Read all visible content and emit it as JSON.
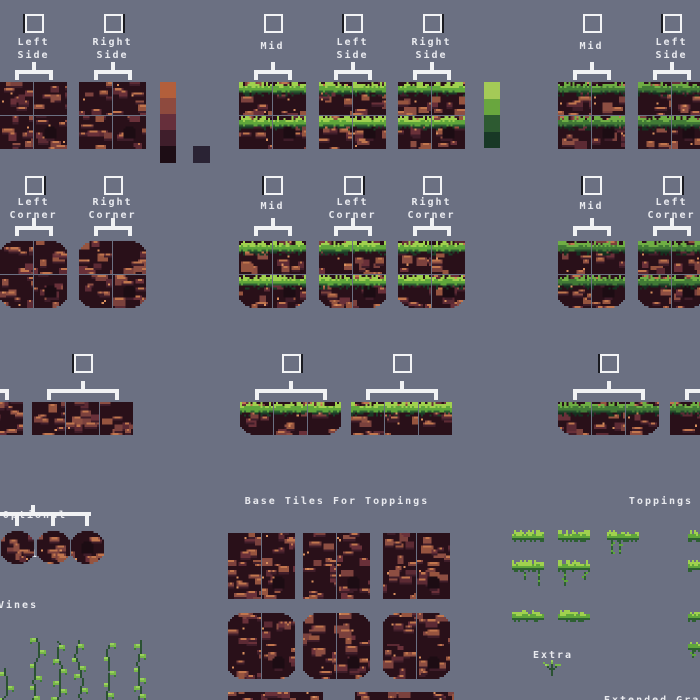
{
  "background": "#6b7082",
  "ui": {
    "checkbox_border": "#f2f3f5",
    "bracket_color": "#f1f2f4",
    "text_color": "#e9eaef"
  },
  "sections": {
    "optional_tiles": {
      "line1": "Optional",
      "line2": "Tiles"
    },
    "base_tiles": {
      "title": "Base Tiles For Toppings"
    },
    "toppings": {
      "title": "Toppings"
    },
    "vines": {
      "title": "Vines"
    },
    "extra": {
      "title": "Extra"
    },
    "extended_grass": {
      "title": "Extended Grass"
    }
  },
  "palettes": [
    {
      "name": "dirt-palette",
      "x": 160,
      "y": 82,
      "w": 16,
      "heights": [
        16,
        16,
        16,
        16,
        17
      ],
      "colors": [
        "#b35f3b",
        "#8e4a3e",
        "#662f3b",
        "#3f1e2b",
        "#1d0d15"
      ]
    },
    {
      "name": "dirt-extra-swatch",
      "x": 193,
      "y": 146,
      "w": 17,
      "heights": [
        17
      ],
      "colors": [
        "#2a2334"
      ]
    },
    {
      "name": "grass-palette",
      "x": 484,
      "y": 82,
      "w": 16,
      "heights": [
        17,
        16,
        17,
        16
      ],
      "colors": [
        "#a4ca57",
        "#69a63e",
        "#2d5a31",
        "#183826"
      ]
    }
  ],
  "row_presets": {
    "r1": {
      "cb": 14,
      "label": 36,
      "bracket": 62,
      "tiles": 82,
      "cols": 2,
      "rows": 2
    },
    "r2": {
      "cb": 176,
      "label": 196,
      "bracket": 218,
      "tiles": 241,
      "cols": 2,
      "rows": 2
    },
    "r3": {
      "cb": 354,
      "label": -1,
      "bracket": 381,
      "tiles": 402,
      "cols": 3,
      "rows": 1
    }
  },
  "tile_groups": [
    {
      "row": "r1",
      "label": [
        "Left",
        "Side"
      ],
      "variant": "dirt",
      "x": 0
    },
    {
      "row": "r1",
      "label": [
        "Right",
        "Side"
      ],
      "variant": "dirt",
      "x": 79
    },
    {
      "row": "r1",
      "label": [
        "Mid"
      ],
      "variant": "grass",
      "x": 239
    },
    {
      "row": "r1",
      "label": [
        "Left",
        "Side"
      ],
      "variant": "grass",
      "x": 319
    },
    {
      "row": "r1",
      "label": [
        "Right",
        "Side"
      ],
      "variant": "grass",
      "x": 398
    },
    {
      "row": "r1",
      "label": [
        "Mid"
      ],
      "variant": "darkgrass",
      "x": 558
    },
    {
      "row": "r1",
      "label": [
        "Left",
        "Side"
      ],
      "variant": "darkgrass",
      "x": 638
    },
    {
      "row": "r2",
      "label": [
        "Left",
        "Corner"
      ],
      "variant": "dirt",
      "x": 0,
      "round": "outer"
    },
    {
      "row": "r2",
      "label": [
        "Right",
        "Corner"
      ],
      "variant": "dirt",
      "x": 79,
      "round": "outer"
    },
    {
      "row": "r2",
      "label": [
        "Mid"
      ],
      "variant": "grass",
      "x": 239,
      "round": "bottom"
    },
    {
      "row": "r2",
      "label": [
        "Left",
        "Corner"
      ],
      "variant": "grass",
      "x": 319,
      "round": "bottom"
    },
    {
      "row": "r2",
      "label": [
        "Right",
        "Corner"
      ],
      "variant": "grass",
      "x": 398,
      "round": "bottom"
    },
    {
      "row": "r2",
      "label": [
        "Mid"
      ],
      "variant": "darkgrass",
      "x": 558,
      "round": "bottom"
    },
    {
      "row": "r2",
      "label": [
        "Left",
        "Corner"
      ],
      "variant": "darkgrass",
      "x": 638,
      "round": "bottom"
    },
    {
      "row": "r3",
      "label": [],
      "variant": "dirt",
      "x": -78
    },
    {
      "row": "r3",
      "label": [],
      "variant": "dirt",
      "x": 32
    },
    {
      "row": "r3",
      "label": [],
      "variant": "grass",
      "x": 240,
      "round": "bottom"
    },
    {
      "row": "r3",
      "label": [],
      "variant": "grass",
      "x": 351
    },
    {
      "row": "r3",
      "label": [],
      "variant": "darkgrass",
      "x": 558,
      "round": "bottom"
    },
    {
      "row": "r3",
      "label": [],
      "variant": "darkgrass",
      "x": 670
    }
  ],
  "optional_row": {
    "y": 531,
    "xs": [
      1,
      37,
      71
    ]
  },
  "base_blocks": [
    {
      "x": 228,
      "y": 533,
      "cols": 2,
      "rows": 2
    },
    {
      "x": 303,
      "y": 533,
      "cols": 2,
      "rows": 2
    },
    {
      "x": 383,
      "y": 533,
      "cols": 2,
      "rows": 2
    },
    {
      "x": 228,
      "y": 613,
      "cols": 2,
      "rows": 2,
      "round": "outer"
    },
    {
      "x": 303,
      "y": 613,
      "cols": 2,
      "rows": 2,
      "round": "outer"
    },
    {
      "x": 383,
      "y": 613,
      "cols": 2,
      "rows": 2,
      "round": "outer"
    },
    {
      "x": 228,
      "y": 692,
      "cols": 3,
      "rows": 1,
      "pitch": 31
    },
    {
      "x": 355,
      "y": 692,
      "cols": 3,
      "rows": 1,
      "pitch": 33
    }
  ],
  "toppings_items": [
    {
      "x": 512,
      "y": 530,
      "hang": false
    },
    {
      "x": 558,
      "y": 530,
      "hang": false
    },
    {
      "x": 607,
      "y": 530,
      "hang": true
    },
    {
      "x": 688,
      "y": 530,
      "hang": false
    },
    {
      "x": 512,
      "y": 560,
      "hang": true
    },
    {
      "x": 558,
      "y": 560,
      "hang": true
    },
    {
      "x": 688,
      "y": 560,
      "hang": true
    },
    {
      "x": 512,
      "y": 610,
      "hang": false
    },
    {
      "x": 558,
      "y": 610,
      "hang": false
    },
    {
      "x": 688,
      "y": 610,
      "hang": false
    },
    {
      "x": 688,
      "y": 640,
      "hang": true
    }
  ],
  "vines_items": [
    {
      "x": -2,
      "y": 668
    },
    {
      "x": 30,
      "y": 638
    },
    {
      "x": 51,
      "y": 641
    },
    {
      "x": 72,
      "y": 640
    },
    {
      "x": 104,
      "y": 643
    },
    {
      "x": 134,
      "y": 640
    }
  ],
  "extra_plant": {
    "x": 541,
    "y": 660
  },
  "art_colors": {
    "dirt_bg": "#291019",
    "rocks": [
      "#7b413d",
      "#8d4e42",
      "#693039",
      "#96543f",
      "#5c2a34"
    ],
    "rock_highlight": "#c1764e",
    "rock_highlight2": "#d98f5e",
    "rock_shadow": "#3f1d29",
    "hole": "#1c0c13",
    "grass_bright": {
      "light": "#a0d14e",
      "mid": "#5fa63b",
      "dark": "#2e6032",
      "deep": "#1c3b27"
    },
    "grass_dark": {
      "light": "#6fae44",
      "mid": "#417a36",
      "dark": "#264c2d",
      "deep": "#15301f"
    },
    "vine": {
      "stem": "#2b5233",
      "leaf": "#79b84a",
      "leaf_light": "#9ad15c",
      "leaf_dark": "#3c7a38"
    }
  }
}
